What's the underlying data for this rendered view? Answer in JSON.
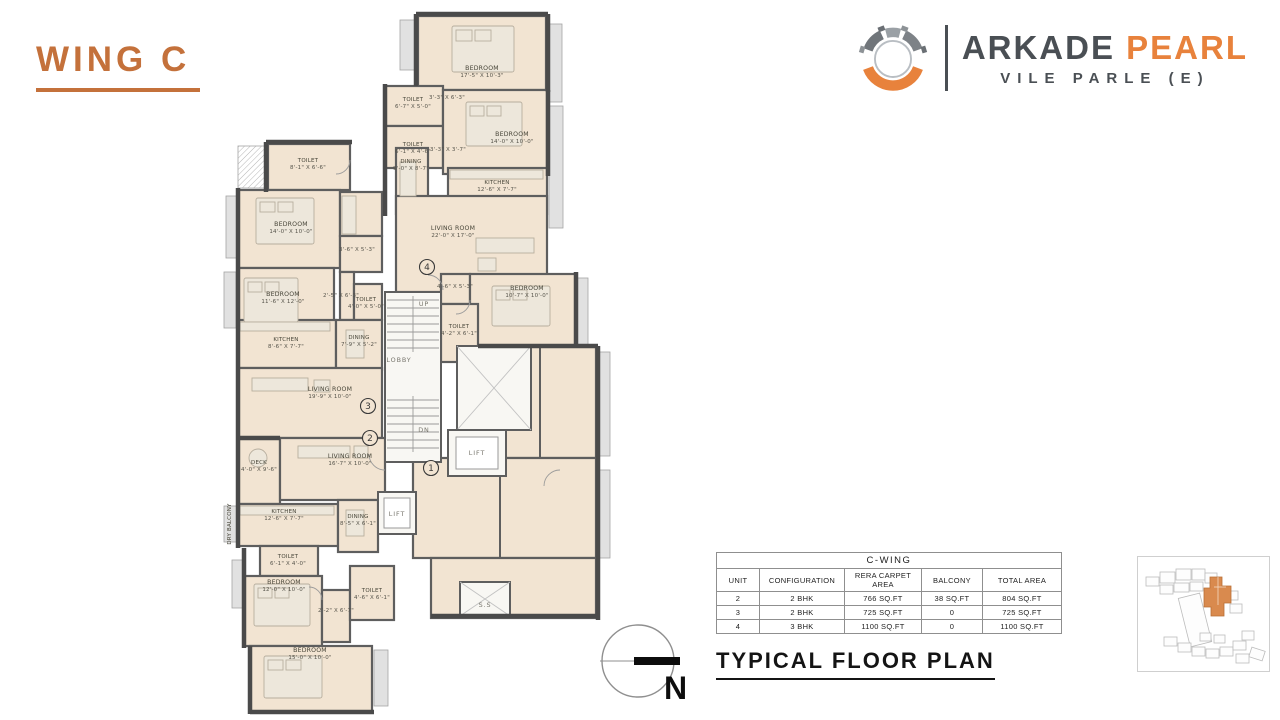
{
  "page": {
    "title": "WING C",
    "plan_caption": "TYPICAL FLOOR PLAN"
  },
  "brand": {
    "name_primary": "ARKADE",
    "name_accent": "PEARL",
    "location": "VILE PARLE (E)",
    "accent_color": "#E8823C",
    "dark_color": "#4A4F54",
    "title_color": "#C4713B"
  },
  "compass": {
    "label": "N"
  },
  "table": {
    "title": "C-WING",
    "columns": [
      "UNIT",
      "CONFIGURATION",
      "RERA CARPET AREA",
      "BALCONY",
      "TOTAL AREA"
    ],
    "rows": [
      [
        "2",
        "2 BHK",
        "766 SQ.FT",
        "38 SQ.FT",
        "804 SQ.FT"
      ],
      [
        "3",
        "2 BHK",
        "725 SQ.FT",
        "0",
        "725 SQ.FT"
      ],
      [
        "4",
        "3 BHK",
        "1100 SQ.FT",
        "0",
        "1100 SQ.FT"
      ]
    ]
  },
  "floor_plan": {
    "plan_fill": "#F2E4D2",
    "rooms": [
      {
        "name": "BEDROOM",
        "dims": "17'-5\" X 10'-3\"",
        "x": 482,
        "y": 70
      },
      {
        "name": "TOILET",
        "dims": "6'-7\" X 5'-0\"",
        "x": 413,
        "y": 101,
        "small": true
      },
      {
        "name": "TOILET",
        "dims": "6'-1\" X 4'-6\"",
        "x": 413,
        "y": 146,
        "small": true
      },
      {
        "name": "BEDROOM",
        "dims": "14'-0\" X 10'-0\"",
        "x": 512,
        "y": 136
      },
      {
        "name": "DINING",
        "dims": "9'-0\" X 8'-7\"",
        "x": 411,
        "y": 163,
        "small": true
      },
      {
        "name": "KITCHEN",
        "dims": "12'-6\" X 7'-7\"",
        "x": 497,
        "y": 184,
        "small": true
      },
      {
        "name": "LIVING ROOM",
        "dims": "22'-0\" X 17'-0\"",
        "x": 453,
        "y": 230
      },
      {
        "name": "BEDROOM",
        "dims": "10'-7\" X 10'-0\"",
        "x": 527,
        "y": 290
      },
      {
        "name": "TOILET",
        "dims": "4'-2\" X 6'-1\"",
        "x": 459,
        "y": 328,
        "small": true
      },
      {
        "dims": "3'-3\" X 6'-3\"",
        "x": 447,
        "y": 99,
        "small": true
      },
      {
        "dims": "3'-3\" X 3'-7\"",
        "x": 448,
        "y": 151,
        "small": true
      },
      {
        "dims": "4'-6\" X 5'-3\"",
        "x": 455,
        "y": 288,
        "small": true
      },
      {
        "name": "TOILET",
        "dims": "8'-1\" X 6'-6\"",
        "x": 308,
        "y": 162,
        "small": true
      },
      {
        "name": "BEDROOM",
        "dims": "14'-0\" X 10'-0\"",
        "x": 291,
        "y": 226
      },
      {
        "name": "BEDROOM",
        "dims": "11'-6\" X 12'-0\"",
        "x": 283,
        "y": 296
      },
      {
        "dims": "3'-6\" X 5'-3\"",
        "x": 357,
        "y": 251,
        "small": true
      },
      {
        "dims": "2'-5\" X 6'-3\"",
        "x": 341,
        "y": 297,
        "small": true
      },
      {
        "name": "TOILET",
        "dims": "4'-0\" X 5'-0\"",
        "x": 366,
        "y": 301,
        "small": true
      },
      {
        "name": "KITCHEN",
        "dims": "8'-6\" X 7'-7\"",
        "x": 286,
        "y": 341,
        "small": true
      },
      {
        "name": "DINING",
        "dims": "7'-9\" X 5'-2\"",
        "x": 359,
        "y": 339,
        "small": true
      },
      {
        "name": "LIVING ROOM",
        "dims": "19'-9\" X 10'-0\"",
        "x": 330,
        "y": 391
      },
      {
        "name": "DECK",
        "dims": "4'-0\" X 9'-6\"",
        "x": 259,
        "y": 464,
        "small": true
      },
      {
        "name": "LIVING ROOM",
        "dims": "16'-7\" X 10'-0\"",
        "x": 350,
        "y": 458
      },
      {
        "name": "KITCHEN",
        "dims": "12'-6\" X 7'-7\"",
        "x": 284,
        "y": 513,
        "small": true
      },
      {
        "name": "DRY BALCONY",
        "x": 231,
        "y": 524,
        "small": true,
        "rot": -90
      },
      {
        "name": "DINING",
        "dims": "8'-5\" X 6'-1\"",
        "x": 358,
        "y": 518,
        "small": true
      },
      {
        "name": "TOILET",
        "dims": "6'-1\" X 4'-0\"",
        "x": 288,
        "y": 558,
        "small": true
      },
      {
        "name": "BEDROOM",
        "dims": "12'-0\" X 10'-0\"",
        "x": 284,
        "y": 584
      },
      {
        "name": "TOILET",
        "dims": "4'-6\" X 6'-1\"",
        "x": 372,
        "y": 592,
        "small": true
      },
      {
        "dims": "2'-2\" X 6'-7\"",
        "x": 336,
        "y": 612,
        "small": true
      },
      {
        "name": "BEDROOM",
        "dims": "15'-0\" X 10'-0\"",
        "x": 310,
        "y": 652
      }
    ],
    "core_labels": [
      {
        "text": "LOBBY",
        "x": 399,
        "y": 362
      },
      {
        "text": "UP",
        "x": 424,
        "y": 306
      },
      {
        "text": "DN",
        "x": 424,
        "y": 432
      },
      {
        "text": "LIFT",
        "x": 477,
        "y": 455
      },
      {
        "text": "LIFT",
        "x": 397,
        "y": 516
      },
      {
        "text": "S.S",
        "x": 485,
        "y": 607
      }
    ],
    "unit_markers": [
      {
        "num": "1",
        "x": 431,
        "y": 468
      },
      {
        "num": "2",
        "x": 370,
        "y": 438
      },
      {
        "num": "3",
        "x": 368,
        "y": 406
      },
      {
        "num": "4",
        "x": 427,
        "y": 267
      }
    ]
  }
}
